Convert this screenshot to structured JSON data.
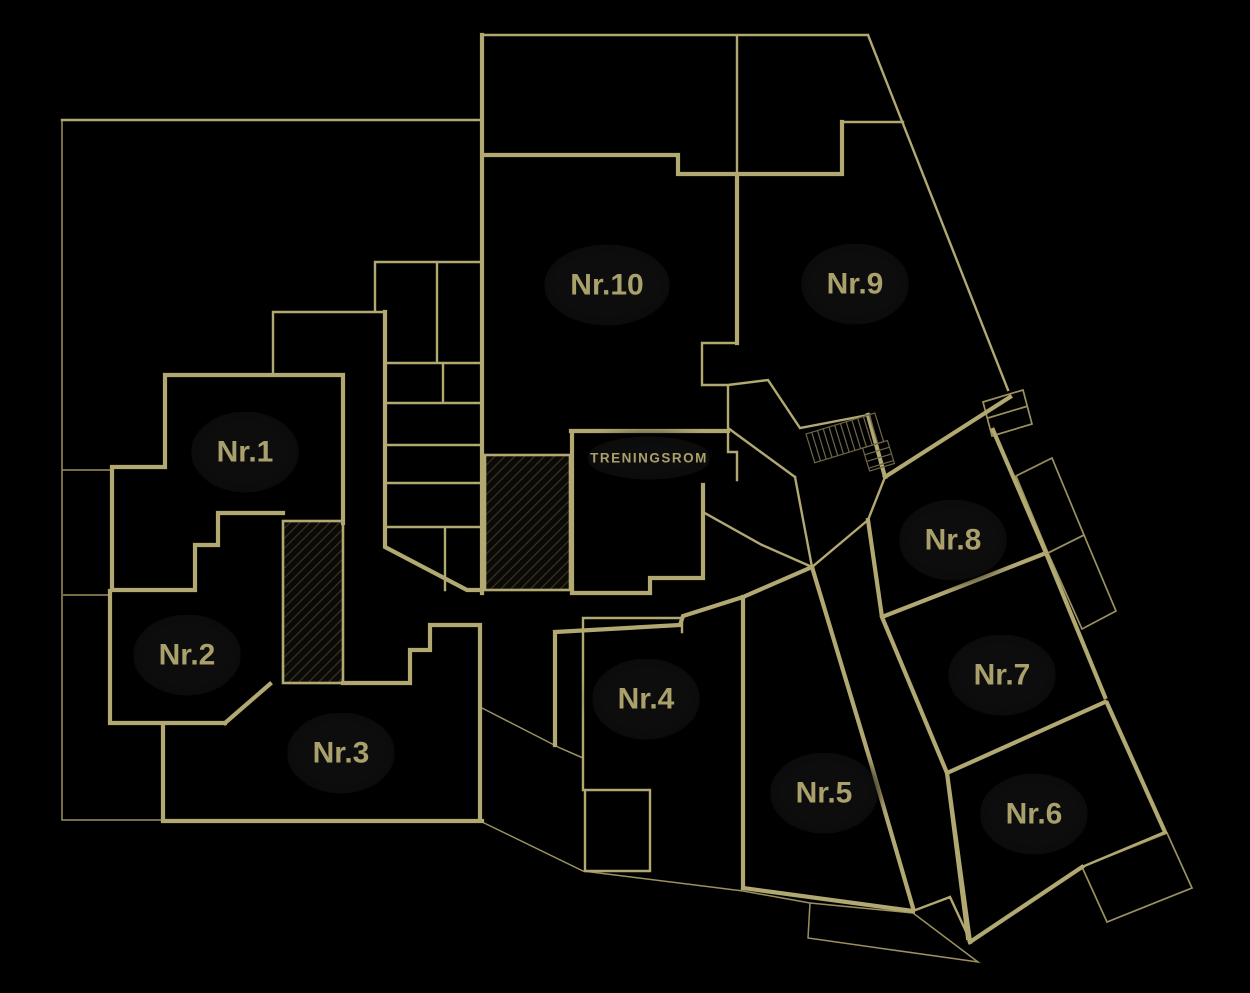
{
  "plan": {
    "title": "floor-plan",
    "colors": {
      "background": "#000000",
      "wall": "#b2a872",
      "wall_dim": "#9a9160",
      "label": "#a9a06b",
      "halo": "#0d0c08",
      "hatch_bg": "#0b0a06",
      "hatch_line": "#3a3420",
      "stair": "#6e6748"
    },
    "units": [
      {
        "id": "nr-1",
        "label": "Nr.1",
        "x": 245,
        "y": 452,
        "font_size": 30,
        "letter_spacing": 0
      },
      {
        "id": "nr-2",
        "label": "Nr.2",
        "x": 187,
        "y": 655,
        "font_size": 30,
        "letter_spacing": 0
      },
      {
        "id": "nr-3",
        "label": "Nr.3",
        "x": 341,
        "y": 753,
        "font_size": 30,
        "letter_spacing": 0
      },
      {
        "id": "nr-4",
        "label": "Nr.4",
        "x": 646,
        "y": 699,
        "font_size": 30,
        "letter_spacing": 0
      },
      {
        "id": "nr-5",
        "label": "Nr.5",
        "x": 824,
        "y": 793,
        "font_size": 30,
        "letter_spacing": 0
      },
      {
        "id": "nr-6",
        "label": "Nr.6",
        "x": 1034,
        "y": 814,
        "font_size": 30,
        "letter_spacing": 0
      },
      {
        "id": "nr-7",
        "label": "Nr.7",
        "x": 1002,
        "y": 675,
        "font_size": 30,
        "letter_spacing": 0
      },
      {
        "id": "nr-8",
        "label": "Nr.8",
        "x": 953,
        "y": 540,
        "font_size": 30,
        "letter_spacing": 0
      },
      {
        "id": "nr-9",
        "label": "Nr.9",
        "x": 855,
        "y": 284,
        "font_size": 30,
        "letter_spacing": 0
      },
      {
        "id": "nr-10",
        "label": "Nr.10",
        "x": 607,
        "y": 285,
        "font_size": 30,
        "letter_spacing": 0
      },
      {
        "id": "treningsrom",
        "label": "TRENINGSROM",
        "x": 649,
        "y": 458,
        "font_size": 13.5,
        "letter_spacing": 1.5
      }
    ]
  }
}
